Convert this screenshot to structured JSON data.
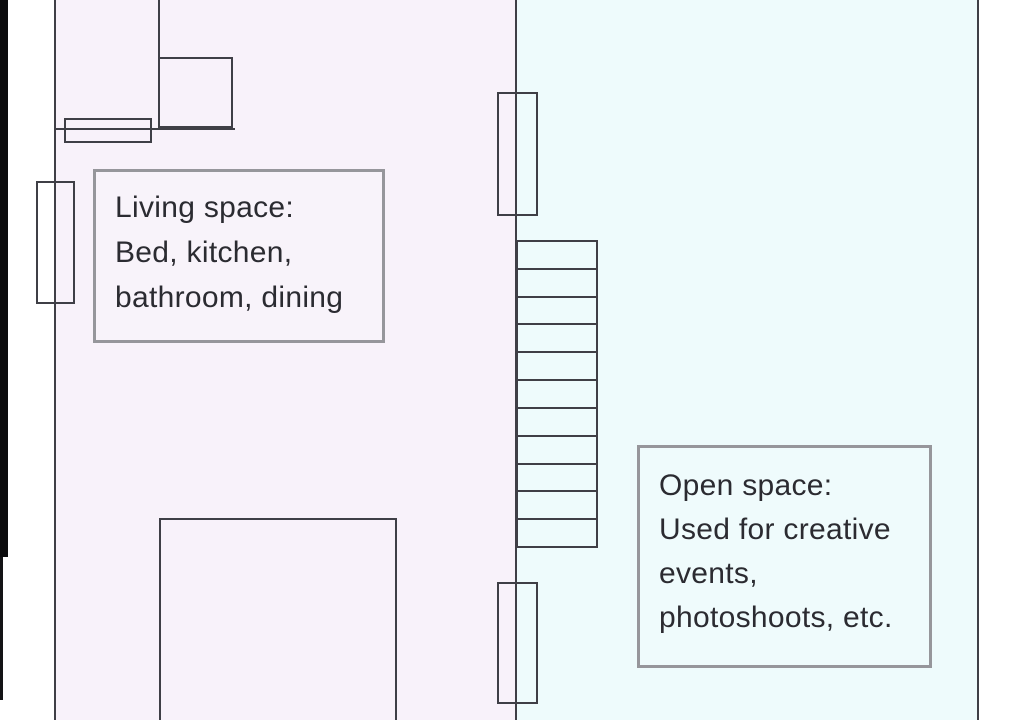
{
  "diagram": {
    "type": "floor-plan",
    "living_space": {
      "label_lines": [
        "Living space:",
        "Bed, kitchen,",
        "bathroom, dining"
      ],
      "area_color": "#f8f2fa"
    },
    "open_space": {
      "label_lines": [
        "Open space:",
        "Used for creative",
        "events,",
        "photoshoots, etc."
      ],
      "area_color": "#eefbfc"
    },
    "staircase": {
      "step_count": 11
    },
    "colors": {
      "wall": "#3f3f46",
      "label_border": "#96969b",
      "text": "#2b2b31",
      "outside": "#ffffff"
    }
  }
}
